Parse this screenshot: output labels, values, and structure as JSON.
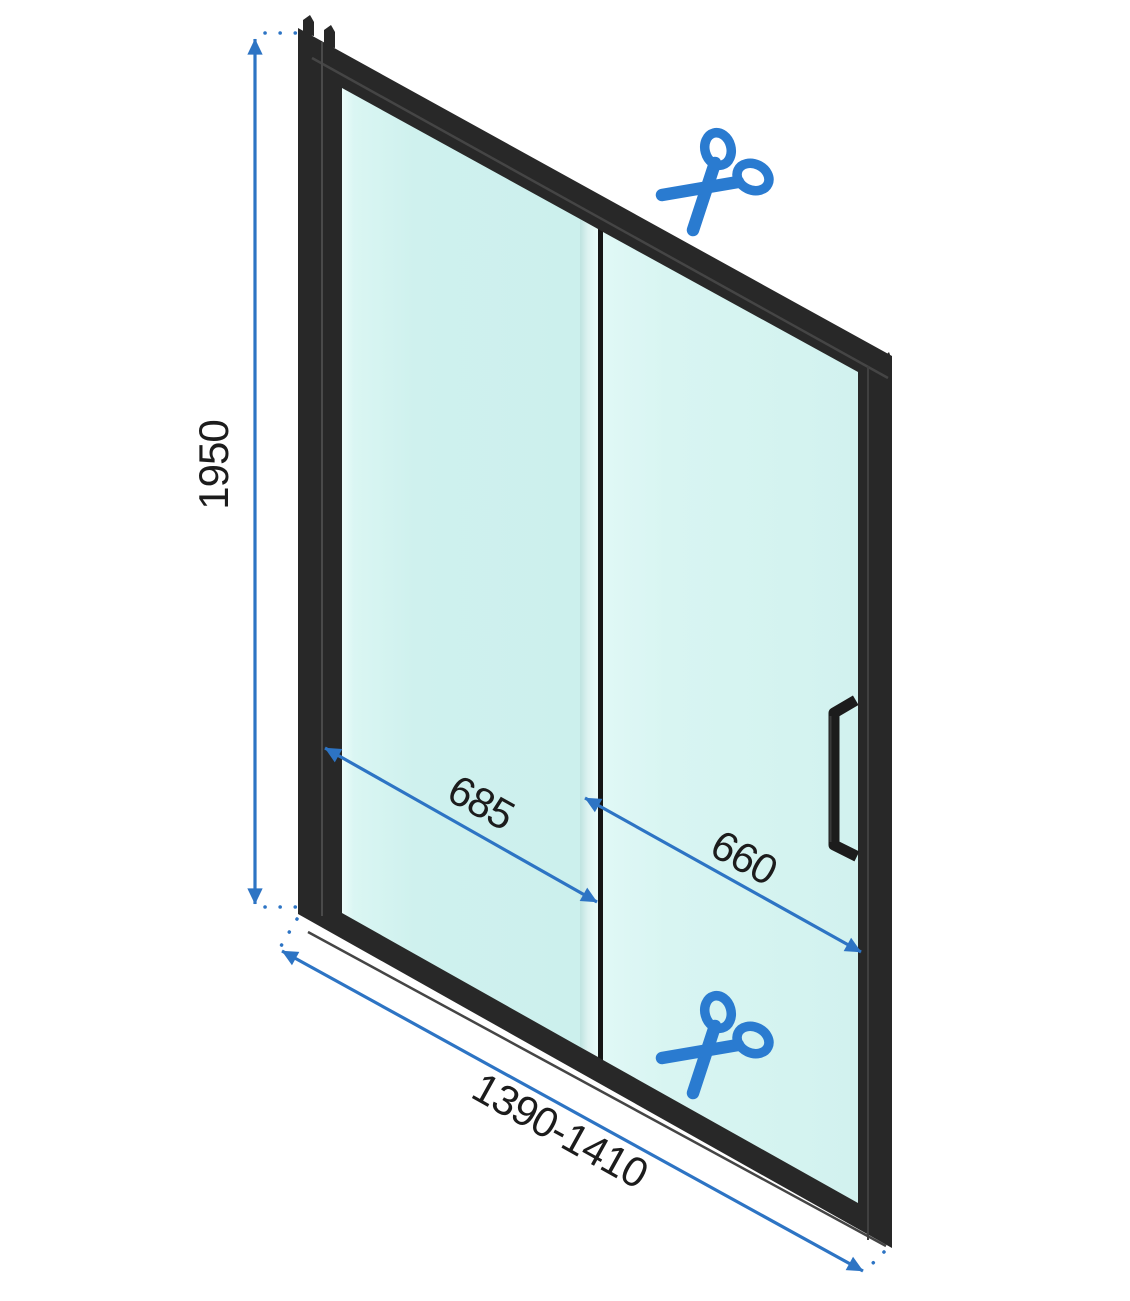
{
  "diagram": {
    "name": "shower-sliding-door-dimension-diagram",
    "labels": {
      "height": "1950",
      "fixed_panel_width": "685",
      "door_panel_width": "660",
      "total_width_range": "1390-1410"
    },
    "icons": {
      "cut_marker_top": "scissors-icon",
      "cut_marker_bottom": "scissors-icon"
    },
    "colors": {
      "dimension_blue": "#2d74c4",
      "scissors_blue": "#2a7bd0",
      "glass_tint": "#cdf0ed",
      "glass_highlight": "#e8fbf9",
      "frame_black": "#282828",
      "label_text": "#1c1c1c",
      "background": "#ffffff"
    }
  }
}
